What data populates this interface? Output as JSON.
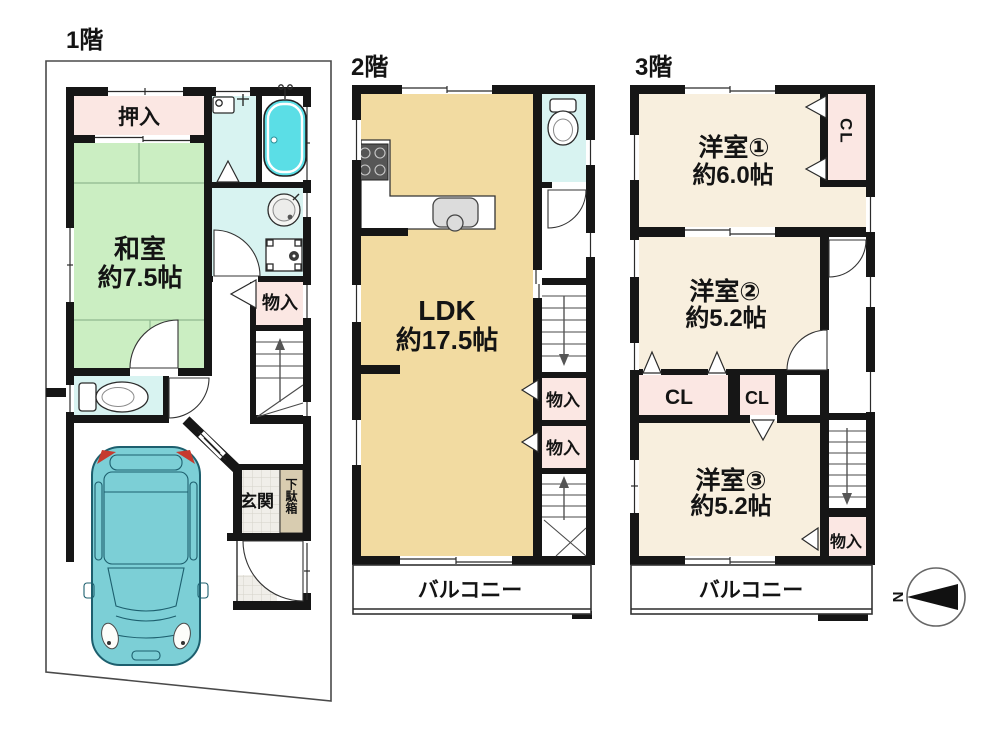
{
  "document": {
    "type": "floor-plan",
    "floors": 3
  },
  "colors": {
    "wall": "#161616",
    "lot_line": "#4a4a4a",
    "tatami_green": "#cbeec2",
    "closet_pink": "#fbe7e3",
    "water_cyan": "#d8f3f1",
    "tub_cyan": "#5bdee6",
    "ldk_tan": "#f2dba1",
    "room_cream": "#f8efde",
    "shoe_cabinet_tan": "#d8ccb0",
    "car_body": "#7ccfd6",
    "car_accent_red": "#c63b2f"
  },
  "floor1": {
    "title": "1階",
    "oshiire": "押入",
    "washitsu": [
      "和室",
      "約7.5帖"
    ],
    "monoire": "物入",
    "genkan": "玄関",
    "getabako": "下駄箱"
  },
  "floor2": {
    "title": "2階",
    "ldk": [
      "LDK",
      "約17.5帖"
    ],
    "monoire_upper": "物入",
    "monoire_lower": "物入",
    "balcony": "バルコニー"
  },
  "floor3": {
    "title": "3階",
    "room1": [
      "洋室①",
      "約6.0帖"
    ],
    "room1_closet": "CL",
    "room2": [
      "洋室②",
      "約5.2帖"
    ],
    "closet_left": "CL",
    "closet_right": "CL",
    "room3": [
      "洋室③",
      "約5.2帖"
    ],
    "monoire": "物入",
    "balcony": "バルコニー"
  },
  "compass": {
    "north": "N"
  }
}
